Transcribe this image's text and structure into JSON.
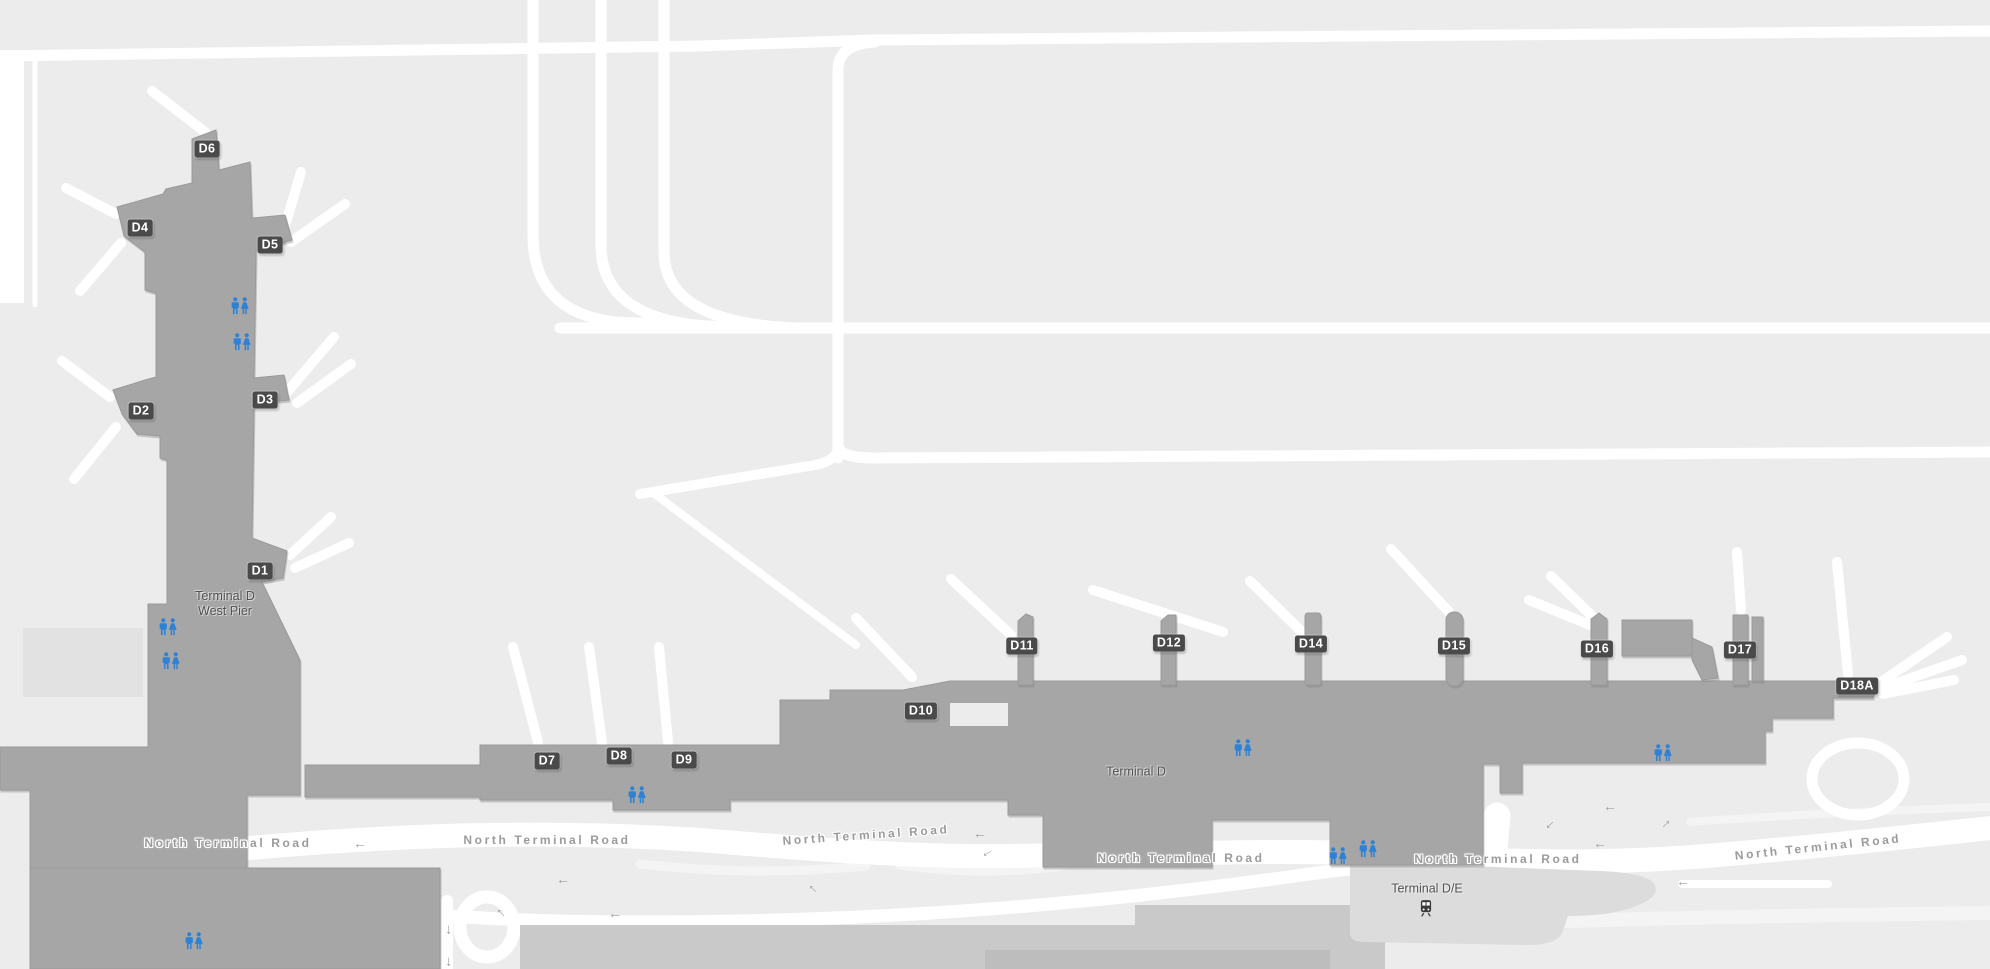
{
  "map": {
    "title": "Airport terminal map — Terminal D",
    "colors": {
      "background": "#ececec",
      "building": "#a6a6a6",
      "building_light": "#e2e2e2",
      "station_building": "#dcdcdc",
      "parking": "#c9c9c9",
      "road": "#ffffff",
      "gate_badge": "#4a4a4a",
      "gate_text": "#ffffff",
      "road_label": "#9b9b9b",
      "area_label": "#4f4f4f",
      "restroom_blue": "#2e82d6",
      "train_icon": "#3a3a3a"
    },
    "area_labels": [
      {
        "lines": [
          "Terminal D",
          "West Pier"
        ],
        "x": 225,
        "y": 604
      },
      {
        "lines": [
          "Terminal D"
        ],
        "x": 1136,
        "y": 772
      },
      {
        "lines": [
          "Terminal D/E"
        ],
        "x": 1427,
        "y": 889
      }
    ],
    "gates": [
      {
        "id": "D6",
        "x": 207,
        "y": 149
      },
      {
        "id": "D4",
        "x": 140,
        "y": 228
      },
      {
        "id": "D5",
        "x": 270,
        "y": 245
      },
      {
        "id": "D2",
        "x": 141,
        "y": 411
      },
      {
        "id": "D3",
        "x": 265,
        "y": 400
      },
      {
        "id": "D1",
        "x": 260,
        "y": 571
      },
      {
        "id": "D7",
        "x": 547,
        "y": 761
      },
      {
        "id": "D8",
        "x": 619,
        "y": 756
      },
      {
        "id": "D9",
        "x": 684,
        "y": 760
      },
      {
        "id": "D10",
        "x": 921,
        "y": 711
      },
      {
        "id": "D11",
        "x": 1022,
        "y": 646
      },
      {
        "id": "D12",
        "x": 1169,
        "y": 643
      },
      {
        "id": "D14",
        "x": 1311,
        "y": 644
      },
      {
        "id": "D15",
        "x": 1454,
        "y": 646
      },
      {
        "id": "D16",
        "x": 1597,
        "y": 649
      },
      {
        "id": "D17",
        "x": 1740,
        "y": 650
      },
      {
        "id": "D18A",
        "x": 1857,
        "y": 686
      }
    ],
    "road_labels": [
      {
        "text": "North Terminal Road",
        "x": 228,
        "y": 843,
        "rotate": 0
      },
      {
        "text": "North Terminal Road",
        "x": 547,
        "y": 840,
        "rotate": 0
      },
      {
        "text": "North Terminal Road",
        "x": 866,
        "y": 835,
        "rotate": -4
      },
      {
        "text": "North Terminal Road",
        "x": 1181,
        "y": 858,
        "rotate": 0
      },
      {
        "text": "North Terminal Road",
        "x": 1498,
        "y": 859,
        "rotate": 0
      },
      {
        "text": "North Terminal Road",
        "x": 1818,
        "y": 847,
        "rotate": -6
      }
    ],
    "restrooms": [
      {
        "x": 240,
        "y": 306
      },
      {
        "x": 242,
        "y": 342
      },
      {
        "x": 168,
        "y": 627
      },
      {
        "x": 171,
        "y": 661
      },
      {
        "x": 637,
        "y": 795
      },
      {
        "x": 1243,
        "y": 748
      },
      {
        "x": 1663,
        "y": 753
      },
      {
        "x": 1338,
        "y": 856
      },
      {
        "x": 1368,
        "y": 849
      },
      {
        "x": 194,
        "y": 941
      }
    ],
    "arrows": [
      {
        "x": 360,
        "y": 843,
        "rotate": 0
      },
      {
        "x": 980,
        "y": 833,
        "rotate": 0
      },
      {
        "x": 986,
        "y": 851,
        "rotate": -30
      },
      {
        "x": 1610,
        "y": 806,
        "rotate": 0
      },
      {
        "x": 1548,
        "y": 823,
        "rotate": -45
      },
      {
        "x": 1668,
        "y": 826,
        "rotate": 135
      },
      {
        "x": 1600,
        "y": 843,
        "rotate": 0
      },
      {
        "x": 563,
        "y": 879,
        "rotate": 0
      },
      {
        "x": 815,
        "y": 887,
        "rotate": 45
      },
      {
        "x": 503,
        "y": 911,
        "rotate": 45
      },
      {
        "x": 615,
        "y": 913,
        "rotate": 0
      },
      {
        "x": 446,
        "y": 930,
        "rotate": -90
      },
      {
        "x": 446,
        "y": 962,
        "rotate": -90
      },
      {
        "x": 1683,
        "y": 881,
        "rotate": 0
      }
    ],
    "icons": {
      "arrow_glyph": "←",
      "restroom": "restroom-icon",
      "train": "train-icon"
    },
    "transit_station": {
      "x": 1426,
      "y": 908
    }
  }
}
